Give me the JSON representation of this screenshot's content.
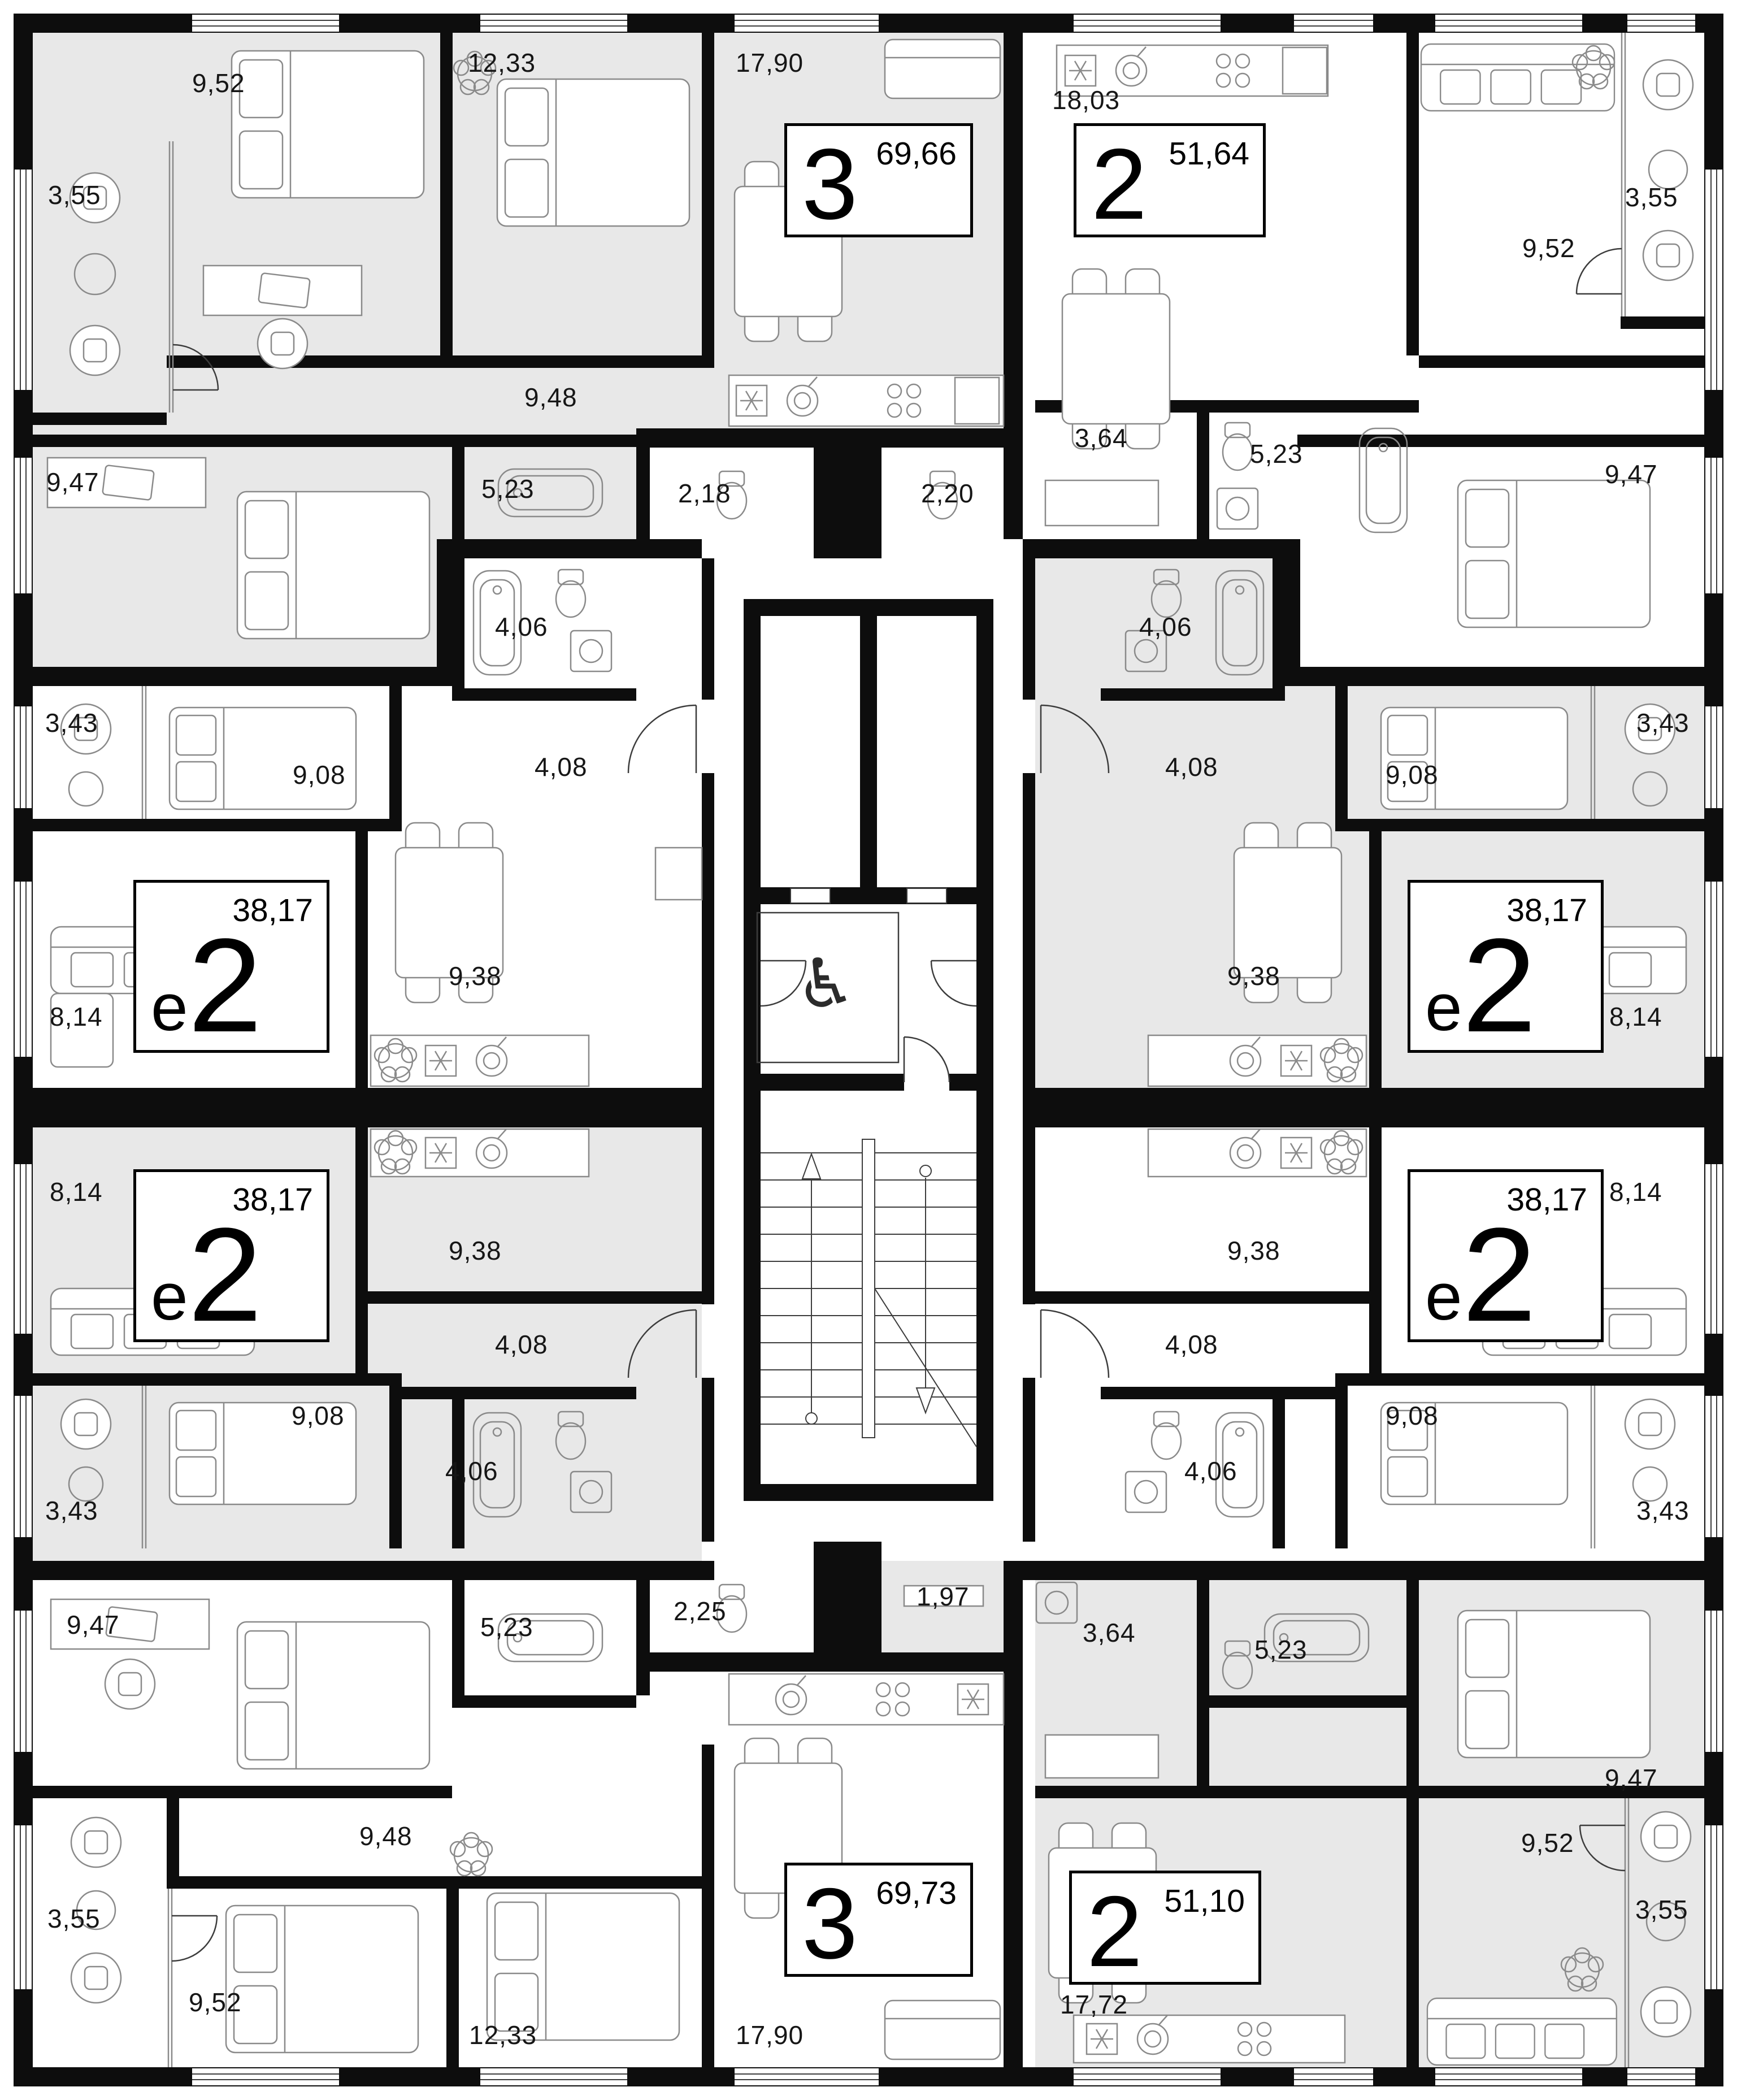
{
  "palette": {
    "wall": "#0d0d0d",
    "apartment_gray_fill": "#e8e8e8",
    "apartment_white_fill": "#ffffff",
    "furniture_line": "#8a8a8a",
    "label_color": "#161616"
  },
  "core": {
    "elevator_count": 2,
    "accessible_elevator_icon": "wheelchair-icon",
    "wheelchair_glyph": "♿",
    "stairwell": true
  },
  "apartments": [
    {
      "id": "top-left",
      "type_small": "",
      "type_big": "3",
      "area": "69,66",
      "fill": "gray",
      "rooms": [
        {
          "name": "bedroom",
          "area": "9,52"
        },
        {
          "name": "balcony",
          "area": "3,55"
        },
        {
          "name": "bedroom",
          "area": "12,33"
        },
        {
          "name": "kitchen-living",
          "area": "17,90"
        },
        {
          "name": "hallway",
          "area": "9,48"
        },
        {
          "name": "bedroom",
          "area": "9,47"
        },
        {
          "name": "bathroom",
          "area": "5,23"
        },
        {
          "name": "wc",
          "area": "2,18"
        }
      ]
    },
    {
      "id": "top-right",
      "type_small": "",
      "type_big": "2",
      "area": "51,64",
      "fill": "white",
      "rooms": [
        {
          "name": "kitchen-living",
          "area": "18,03"
        },
        {
          "name": "living",
          "area": "9,52"
        },
        {
          "name": "balcony",
          "area": "3,55"
        },
        {
          "name": "bedroom",
          "area": "9,47"
        },
        {
          "name": "hallway",
          "area": "3,64"
        },
        {
          "name": "bathroom",
          "area": "5,23"
        },
        {
          "name": "wc",
          "area": "2,20"
        }
      ]
    },
    {
      "id": "mid-left-upper",
      "type_small": "е",
      "type_big": "2",
      "area": "38,17",
      "fill": "white",
      "rooms": [
        {
          "name": "balcony",
          "area": "3,43"
        },
        {
          "name": "bedroom",
          "area": "9,08"
        },
        {
          "name": "bathroom",
          "area": "4,06"
        },
        {
          "name": "hallway",
          "area": "4,08"
        },
        {
          "name": "living",
          "area": "8,14"
        },
        {
          "name": "kitchen",
          "area": "9,38"
        }
      ]
    },
    {
      "id": "mid-left-lower",
      "type_small": "е",
      "type_big": "2",
      "area": "38,17",
      "fill": "gray",
      "rooms": [
        {
          "name": "balcony",
          "area": "3,43"
        },
        {
          "name": "bedroom",
          "area": "9,08"
        },
        {
          "name": "bathroom",
          "area": "4,06"
        },
        {
          "name": "hallway",
          "area": "4,08"
        },
        {
          "name": "living",
          "area": "8,14"
        },
        {
          "name": "kitchen",
          "area": "9,38"
        }
      ]
    },
    {
      "id": "mid-right-upper",
      "type_small": "е",
      "type_big": "2",
      "area": "38,17",
      "fill": "gray",
      "rooms": [
        {
          "name": "balcony",
          "area": "3,43"
        },
        {
          "name": "bedroom",
          "area": "9,08"
        },
        {
          "name": "bathroom",
          "area": "4,06"
        },
        {
          "name": "hallway",
          "area": "4,08"
        },
        {
          "name": "living",
          "area": "8,14"
        },
        {
          "name": "kitchen",
          "area": "9,38"
        }
      ]
    },
    {
      "id": "mid-right-lower",
      "type_small": "е",
      "type_big": "2",
      "area": "38,17",
      "fill": "white",
      "rooms": [
        {
          "name": "balcony",
          "area": "3,43"
        },
        {
          "name": "bedroom",
          "area": "9,08"
        },
        {
          "name": "bathroom",
          "area": "4,06"
        },
        {
          "name": "hallway",
          "area": "4,08"
        },
        {
          "name": "living",
          "area": "8,14"
        },
        {
          "name": "kitchen",
          "area": "9,38"
        }
      ]
    },
    {
      "id": "bottom-left",
      "type_small": "",
      "type_big": "3",
      "area": "69,73",
      "fill": "white",
      "rooms": [
        {
          "name": "bedroom",
          "area": "9,47"
        },
        {
          "name": "bathroom",
          "area": "5,23"
        },
        {
          "name": "hallway",
          "area": "9,48"
        },
        {
          "name": "wc",
          "area": "2,25"
        },
        {
          "name": "balcony",
          "area": "3,55"
        },
        {
          "name": "bedroom",
          "area": "9,52"
        },
        {
          "name": "bedroom",
          "area": "12,33"
        },
        {
          "name": "kitchen-living",
          "area": "17,90"
        }
      ]
    },
    {
      "id": "bottom-right",
      "type_small": "",
      "type_big": "2",
      "area": "51,10",
      "fill": "gray",
      "rooms": [
        {
          "name": "wardrobe",
          "area": "1,97"
        },
        {
          "name": "hallway",
          "area": "3,64"
        },
        {
          "name": "bathroom",
          "area": "5,23"
        },
        {
          "name": "bedroom",
          "area": "9,47"
        },
        {
          "name": "living",
          "area": "9,52"
        },
        {
          "name": "balcony",
          "area": "3,55"
        },
        {
          "name": "kitchen-living",
          "area": "17,72"
        }
      ]
    }
  ]
}
